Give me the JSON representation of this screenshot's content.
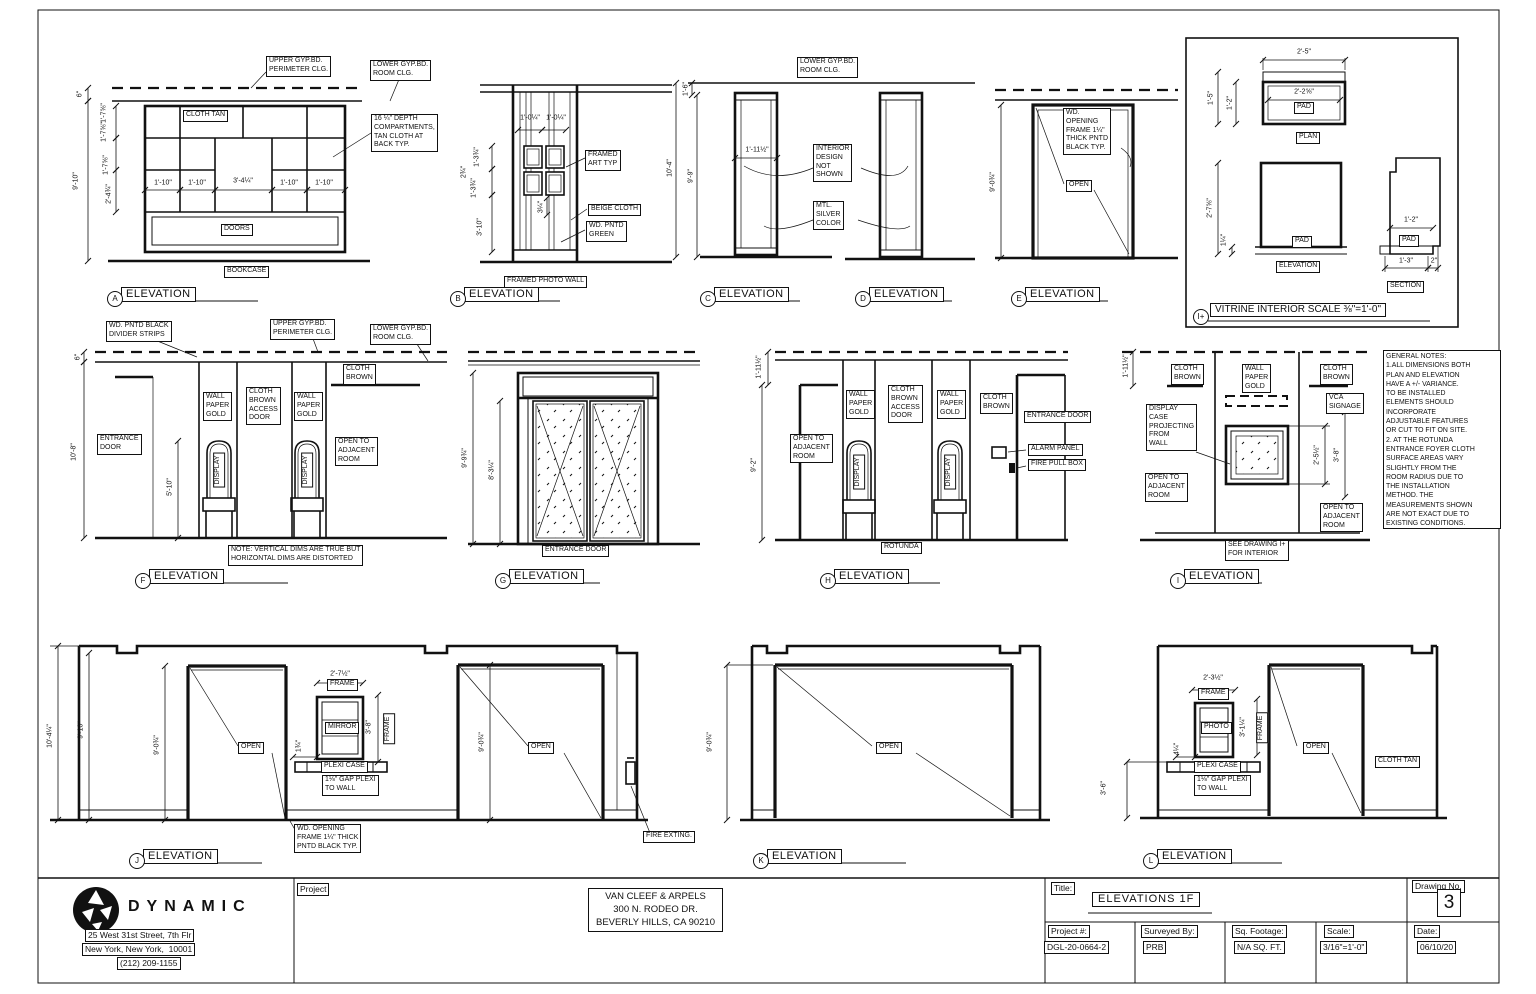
{
  "common": {
    "elevation": "ELEVATION",
    "open": "OPEN",
    "display": "DISPLAY",
    "frame": "FRAME",
    "pad": "PAD",
    "entrance_door": "ENTRANCE DOOR",
    "cloth_brown": "CLOTH\nBROWN",
    "cloth_tan": "CLOTH TAN",
    "wall_paper_gold": "WALL\nPAPER\nGOLD",
    "cloth_brown_access_door": "CLOTH\nBROWN\nACCESS\nDOOR",
    "open_to_adjacent_room": "OPEN TO\nADJACENT\nROOM",
    "upper_gyp": "UPPER GYP.BD.\nPERIMETER CLG.",
    "lower_gyp": "LOWER GYP.BD.\nROOM CLG.",
    "plexi_case": "PLEXI CASE",
    "gap_plexi": "1⅛\" GAP PLEXI\nTO WALL",
    "wd_opening_note": "WD. OPENING\nFRAME 1¼\" THICK\nPNTD BLACK TYP.",
    "dim_9_0_3q": "9'-0¾\"",
    "dim_1_11_half": "1'-11½\""
  },
  "elevA": {
    "letter": "A",
    "name": "BOOKCASE",
    "doors": "DOORS",
    "depth_note": "16 ¼\" DEPTH\nCOMPARTMENTS,\nTAN CLOTH AT\nBACK TYP.",
    "dim_6": "6\"",
    "dim_9_10": "9'-10\"",
    "dim_1_7_a": "1'-7⅝\"",
    "dim_1_7_b": "1'-7⅝\"",
    "dim_1_7_c": "1'-7⅝\"",
    "dim_2_4": "2'-4¾\"",
    "dim_1_10_a": "1'-10\"",
    "dim_1_10_b": "1'-10\"",
    "dim_3_4": "3'-4¼\"",
    "dim_1_10_c": "1'-10\"",
    "dim_1_10_d": "1'-10\""
  },
  "elevB": {
    "letter": "B",
    "name": "FRAMED PHOTO WALL",
    "framed_art": "FRAMED\nART TYP",
    "beige_cloth": "BEIGE CLOTH",
    "wd_pntd_green": "WD. PNTD\nGREEN",
    "dim_1_0_a": "1'-0¼\"",
    "dim_1_0_b": "1'-0¼\"",
    "dim_1_3_a": "1'-3¾\"",
    "dim_2_3q": "2¾\"",
    "dim_1_3_b": "1'-3¾\"",
    "dim_3_10": "3'-10\"",
    "dim_3_1q": "3¼\""
  },
  "elevCD": {
    "letter_c": "C",
    "letter_d": "D",
    "interior": "INTERIOR\nDESIGN\nNOT\nSHOWN",
    "mtl": "MTL.\nSILVER\nCOLOR",
    "dim_10_4": "10'-4\"",
    "dim_9_9": "9'-9\"",
    "dim_1_6": "1'-6\"",
    "dim_1_11": "1'-11½\""
  },
  "elevE": {
    "letter": "E",
    "wd_opening": "WD.\nOPENING\nFRAME 1¼\"\nTHICK PNTD\nBLACK TYP."
  },
  "vitrine": {
    "letter": "I+",
    "title": "VITRINE INTERIOR SCALE ⅜\"=1'-0\"",
    "plan": "PLAN",
    "elevation": "ELEVATION",
    "section": "SECTION",
    "dim_2_5": "2'-5\"",
    "dim_2_2": "2'-2⅝\"",
    "dim_1_5": "1'-5\"",
    "dim_1_2a": "1'-2\"",
    "dim_2_7": "2'-7⅝\"",
    "dim_1_quarter": "1¼\"",
    "dim_1_2b": "1'-2\"",
    "dim_1_3": "1'-3\"",
    "dim_2": "2\""
  },
  "elevF": {
    "letter": "F",
    "divider": "WD. PNTD BLACK\nDIVIDER STRIPS",
    "entrance": "ENTRANCE\nDOOR",
    "dim_6": "6\"",
    "dim_10_8": "10'-8\"",
    "dim_5_10": "5'-10\"",
    "note": "NOTE: VERTICAL DIMS ARE TRUE BUT\nHORIZONTAL DIMS ARE DISTORTED"
  },
  "elevG": {
    "letter": "G",
    "dim_9_9": "9'-9¾\"",
    "dim_8_3": "8'-3¼\""
  },
  "elevH": {
    "letter": "H",
    "dim_9_2": "9'-2\"",
    "alarm": "ALARM PANEL",
    "fire_pull": "FIRE PULL BOX",
    "rotunda": "ROTUNDA"
  },
  "elevI": {
    "letter": "I",
    "vca": "VCA\nSIGNAGE",
    "display_case": "DISPLAY\nCASE\nPROJECTING\nFROM\nWALL",
    "see_drawing": "SEE DRAWING I+\nFOR INTERIOR",
    "dim_2_5": "2'-5½\"",
    "dim_3_8": "3'-8\""
  },
  "notes": {
    "text": "GENERAL NOTES:\n1.ALL DIMENSIONS BOTH\nPLAN AND ELEVATION\nHAVE A +/- VARIANCE.\nTO BE INSTALLED\nELEMENTS SHOULD\nINCORPORATE\nADJUSTABLE FEATURES\nOR CUT TO FIT ON SITE.\n2. AT THE ROTUNDA\nENTRANCE FOYER CLOTH\nSURFACE AREAS VARY\nSLIGHTLY FROM THE\nROOM RADIUS DUE TO\nTHE INSTALLATION\nMETHOD. THE\nMEASUREMENTS SHOWN\nARE NOT EXACT DUE TO\nEXISTING CONDITIONS."
  },
  "elevJ": {
    "letter": "J",
    "mirror": "MIRROR",
    "fire_exting": "FIRE EXTING.",
    "dim_10_4": "10'-4¼\"",
    "dim_9_10": "9'-10\"",
    "dim_2_7": "2'-7½\"",
    "dim_3_8": "3'-8\"",
    "dim_1_3q": "1¾\""
  },
  "elevK": {
    "letter": "K"
  },
  "elevL": {
    "letter": "L",
    "photo": "PHOTO",
    "dim_3_6": "3'-6\"",
    "dim_2_3": "2'-3½\"",
    "dim_3_1": "3'-1¼\"",
    "dim_4_1q": "4¼\""
  },
  "titleblock": {
    "firm": "DYNAMIC",
    "address1": "25 West 31st Street, 7th Flr",
    "address2": "New York, New York,  10001",
    "phone": "(212) 209-1155",
    "project_label": "Project",
    "client": "VAN CLEEF & ARPELS\n300 N. RODEO DR.\nBEVERLY HILLS, CA 90210",
    "title_label": "Title:",
    "title": "ELEVATIONS 1F",
    "drawing_no_label": "Drawing No.",
    "drawing_no": "3",
    "project_no_label": "Project #:",
    "project_no": "DGL-20-0664-2",
    "surveyed_label": "Surveyed By:",
    "surveyed_by": "PRB",
    "sqft_label": "Sq. Footage:",
    "sqft": "N/A SQ. FT.",
    "scale_label": "Scale:",
    "scale": "3/16\"=1'-0\"",
    "date_label": "Date:",
    "date": "06/10/20"
  }
}
